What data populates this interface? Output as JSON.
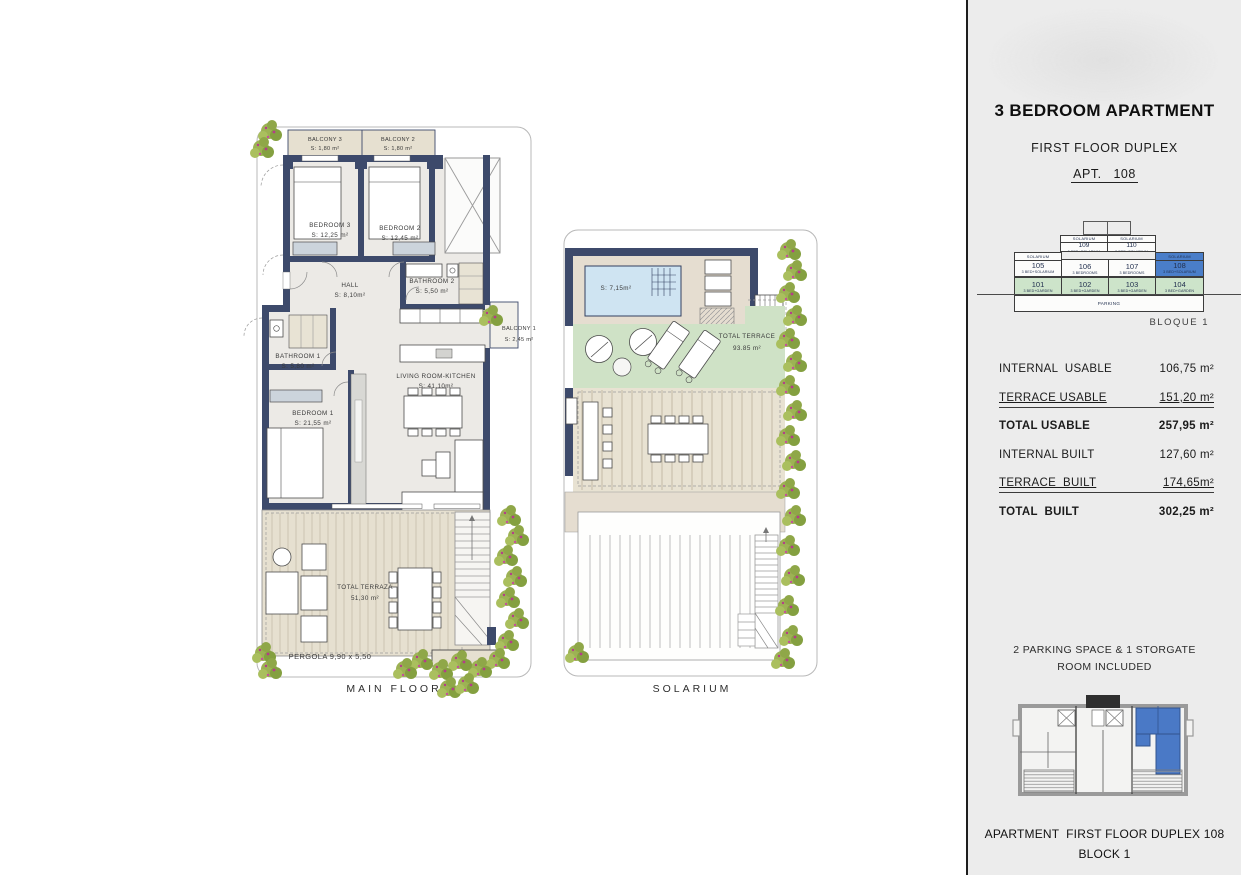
{
  "panel": {
    "title": "3 BEDROOM APARTMENT",
    "subtitle": "FIRST FLOOR DUPLEX",
    "apt_label": "APT.   108",
    "diagram": {
      "solarium_strip": "SOLARIUM",
      "row_top": [
        {
          "num": "109",
          "type": "3 BED+SOLARIUM"
        },
        {
          "num": "110",
          "type": "3 BED+SOLARIUM"
        }
      ],
      "row_mid": [
        {
          "num": "105",
          "type": "3 BED+SOLARIUM"
        },
        {
          "num": "106",
          "type": "3 BEDROOMS"
        },
        {
          "num": "107",
          "type": "3 BEDROOMS"
        },
        {
          "num": "108",
          "type": "3 BED+SOLARIUM"
        }
      ],
      "row_bottom": [
        {
          "num": "101",
          "type": "3 BED+GARDEN"
        },
        {
          "num": "102",
          "type": "3 BED+GARDEN"
        },
        {
          "num": "103",
          "type": "3 BED+GARDEN"
        },
        {
          "num": "104",
          "type": "3 BED+GARDEN"
        }
      ],
      "parking": "PARKING",
      "bloque": "BLOQUE 1"
    },
    "areas": [
      {
        "label": "INTERNAL  USABLE",
        "value": "106,75 m²"
      },
      {
        "label": "TERRACE USABLE",
        "value": "151,20 m²"
      },
      {
        "label": "TOTAL USABLE",
        "value": "257,95 m²"
      },
      {
        "label": "INTERNAL BUILT",
        "value": "127,60 m²"
      },
      {
        "label": "TERRACE  BUILT",
        "value": "174,65m²"
      },
      {
        "label": "TOTAL  BUILT",
        "value": "302,25 m²"
      }
    ],
    "parking_note_1": "2 PARKING SPACE & 1 STORGATE",
    "parking_note_2": "ROOM INCLUDED",
    "footer_1": "APARTMENT  FIRST FLOOR DUPLEX 108",
    "footer_2": "BLOCK 1"
  },
  "main_floor": {
    "caption": "MAIN FLOOR",
    "balcony3": {
      "name": "BALCONY 3",
      "area": "S: 1,80 m²"
    },
    "balcony2": {
      "name": "BALCONY 2",
      "area": "S: 1,80 m²"
    },
    "bedroom3": {
      "name": "BEDROOM 3",
      "area": "S: 12,25 m²"
    },
    "bedroom2": {
      "name": "BEDROOM 2",
      "area": "S: 12,45 m²"
    },
    "hall": {
      "name": "HALL",
      "area": "S: 8,10m²"
    },
    "bathroom2": {
      "name": "BATHROOM 2",
      "area": "S: 5,50 m²"
    },
    "bathroom1": {
      "name": "BATHROOM 1",
      "area": "S: 5,80 m²"
    },
    "balcony1": {
      "name": "BALCONY 1",
      "area": "S: 2,45 m²"
    },
    "bedroom1": {
      "name": "BEDROOM 1",
      "area": "S: 21,55 m²"
    },
    "living": {
      "name": "LIVING ROOM-KITCHEN",
      "area": "S: 41,10m²"
    },
    "terrace": {
      "name": "TOTAL TERRAZA",
      "area": "51,30 m²"
    },
    "pergola_label": "PERGOLA 9,90 x 5,50"
  },
  "solarium": {
    "caption": "SOLARIUM",
    "pool_area": "S: 7,15m²",
    "terrace": {
      "name": "TOTAL TERRACE",
      "area": "93.85 m²"
    },
    "pergola_label": "PERGOLA 8,95 x 4,45"
  },
  "colors": {
    "wall_navy": "#3d4a6b",
    "terrace_beige": "#e6e0d0",
    "solarium_green": "#cfe2c6",
    "pool_blue": "#cfe4f2",
    "highlight_blue": "#4a7ec9",
    "garden_green": "#cde4ca",
    "panel_bg": "#ececec",
    "greenery": "#8fa748",
    "flowers": "#b53c8a"
  }
}
